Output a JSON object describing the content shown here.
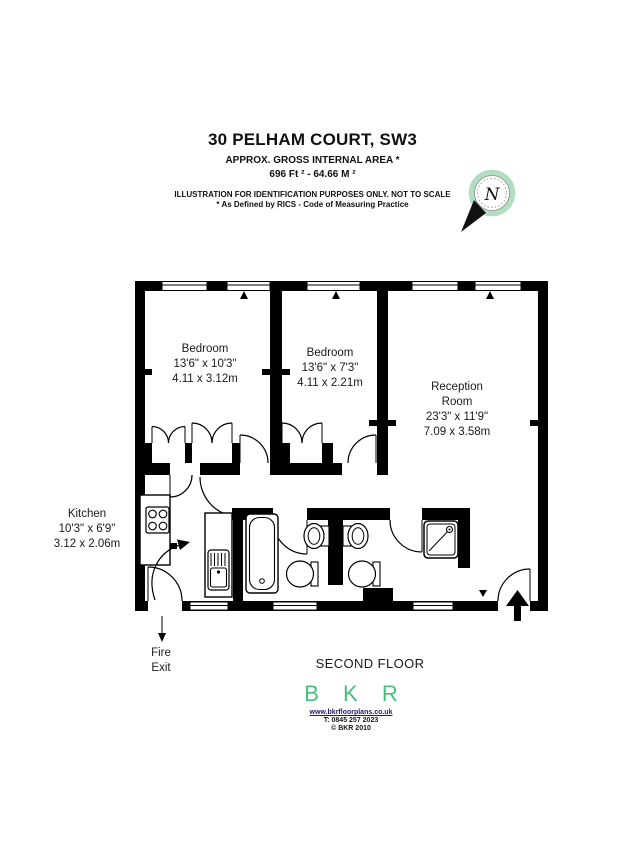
{
  "header": {
    "title": "30 PELHAM COURT, SW3",
    "subtitle": "APPROX. GROSS INTERNAL  AREA *",
    "area": "696 Ft ²  -  64.66 M ²",
    "disclaimer": "ILLUSTRATION FOR IDENTIFICATION PURPOSES ONLY. NOT TO SCALE",
    "rics_note": "* As Defined by RICS - Code of Measuring Practice"
  },
  "compass": {
    "label": "N",
    "ring_color": "#b2ddc2"
  },
  "floorplan": {
    "rooms": [
      {
        "name": "Bedroom",
        "dims_imperial": "13'6\" x 10'3\"",
        "dims_metric": "4.11 x 3.12m"
      },
      {
        "name": "Bedroom",
        "dims_imperial": "13'6\" x 7'3\"",
        "dims_metric": "4.11 x 2.21m"
      },
      {
        "name_line1": "Reception",
        "name_line2": "Room",
        "dims_imperial": "23'3\" x 11'9\"",
        "dims_metric": "7.09 x 3.58m"
      },
      {
        "name": "Kitchen",
        "dims_imperial": "10'3\" x 6'9\"",
        "dims_metric": "3.12 x 2.06m"
      }
    ],
    "fire_exit_line1": "Fire",
    "fire_exit_line2": "Exit",
    "floor_label": "SECOND FLOOR"
  },
  "footer": {
    "logo": "B K R",
    "logo_color": "#45c07e",
    "website": "www.bkrfloorplans.co.uk",
    "phone": "T:  0845 257 2023",
    "copyright": "© BKR 2010"
  }
}
